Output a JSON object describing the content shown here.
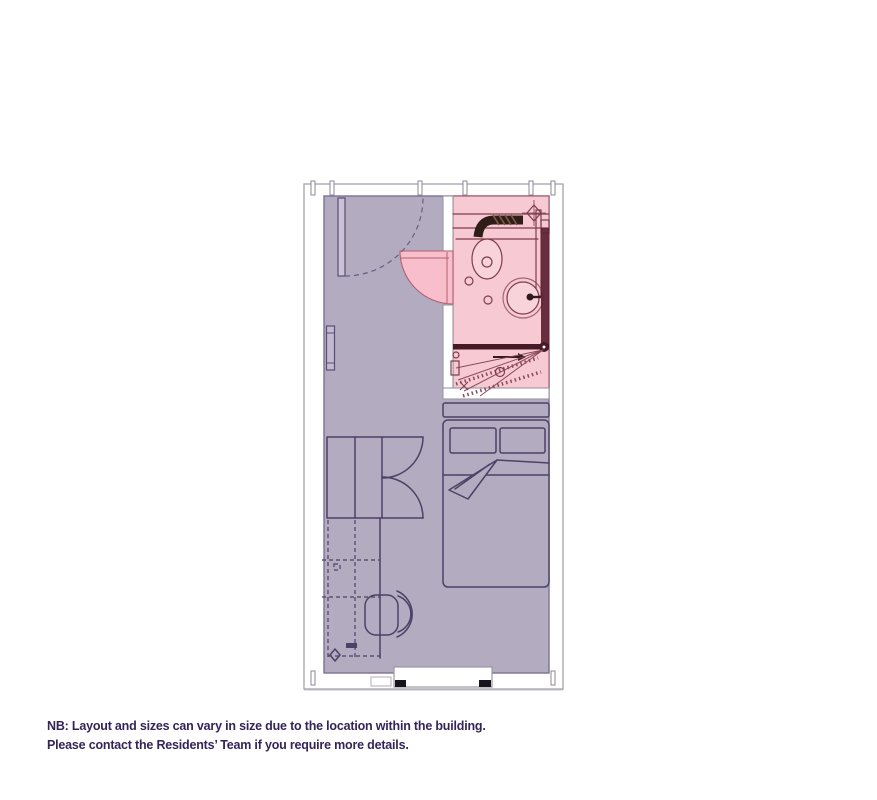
{
  "note": {
    "line1": "NB: Layout and sizes can vary in size due to the location within the building.",
    "line2": "Please contact the Residents’ Team if you require more details."
  },
  "floorplan": {
    "type": "studio-room-floor-plan",
    "colors": {
      "room_fill": "#b3abc0",
      "bathroom_fill": "#f7c9d2",
      "bathroom_door_fill": "#f8becb",
      "furniture_line": "#4c4166",
      "bathroom_line": "#7e3d4b",
      "dark_fixture": "#2f1e17",
      "shower_screen": "#471826",
      "wall_line": "#9b97a1",
      "note_text": "#33255a"
    },
    "areas": [
      {
        "name": "main-room",
        "color_role": "room_fill"
      },
      {
        "name": "bathroom",
        "color_role": "bathroom_fill"
      }
    ],
    "fixtures": [
      "entry-door",
      "bathroom-door",
      "extractor-vent",
      "soil-pipe",
      "toilet",
      "wash-basin",
      "shower",
      "shower-screen",
      "radiator",
      "wardrobe",
      "desk",
      "desk-chair",
      "bed",
      "pillows",
      "headboard",
      "window"
    ]
  }
}
